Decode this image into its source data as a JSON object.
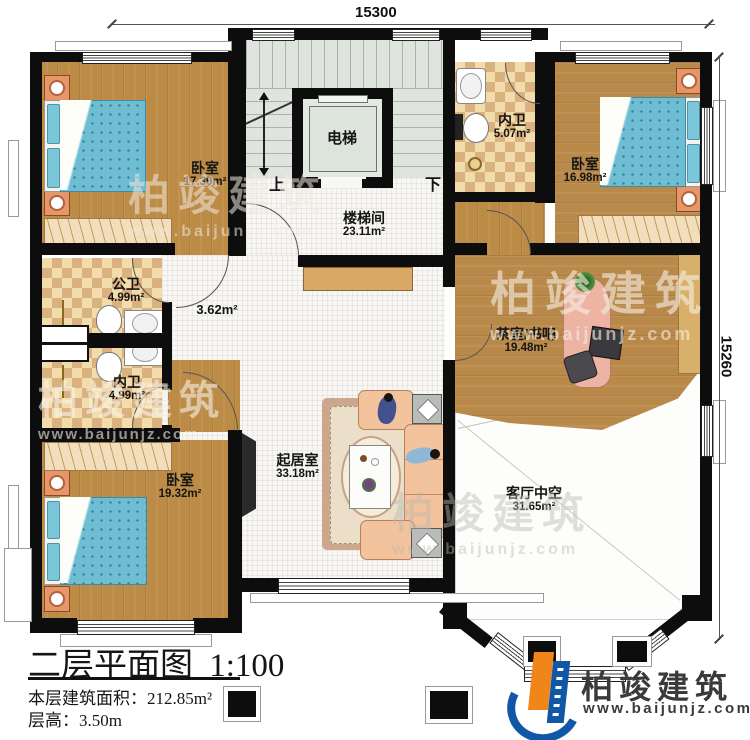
{
  "dimensions": {
    "top": "15300",
    "right": "15260"
  },
  "rooms": {
    "bedroom_tl": {
      "name": "卧室",
      "area": "17.30m²"
    },
    "bedroom_tr": {
      "name": "卧室",
      "area": "16.98m²"
    },
    "bedroom_bl": {
      "name": "卧室",
      "area": "19.32m²"
    },
    "stair_hall": {
      "name": "楼梯间",
      "area": "23.11m²"
    },
    "elevator": {
      "name": "电梯"
    },
    "bath_top": {
      "name": "内卫",
      "area": "5.07m²"
    },
    "bath_public": {
      "name": "公卫",
      "area": "4.99m²"
    },
    "bath_inner": {
      "name": "内卫",
      "area": "4.99m²"
    },
    "hallway": {
      "area": "3.62m²"
    },
    "tea_room": {
      "name": "茶室/书吧",
      "area": "19.48m²"
    },
    "living": {
      "name": "起居室",
      "area": "33.18m²"
    },
    "void": {
      "name": "客厅中空",
      "area": "31.65m²"
    }
  },
  "stairs": {
    "up": "上",
    "down": "下"
  },
  "title_block": {
    "title": "二层平面图",
    "scale": "1:100",
    "area_label": "本层建筑面积：",
    "area_value": "212.85m²",
    "floor_height_label": "层高：",
    "floor_height_value": "3.50m"
  },
  "brand": {
    "name": "柏竣建筑",
    "website": "www.baijunjz.com"
  },
  "colors": {
    "wall": "#0d0d0d",
    "wood": "#bc8b46",
    "tile_light": "#f3dcab",
    "tile_dark": "#d9b27f",
    "stair_floor": "#dfe5de",
    "bed_blue": "#6fbdd3",
    "nightstand": "#e8956a",
    "wardrobe": "#f2debc",
    "sofa": "#f2c39c",
    "desk": "#edb4a4",
    "logo_blue": "#1058a7",
    "logo_orange": "#f08519"
  }
}
